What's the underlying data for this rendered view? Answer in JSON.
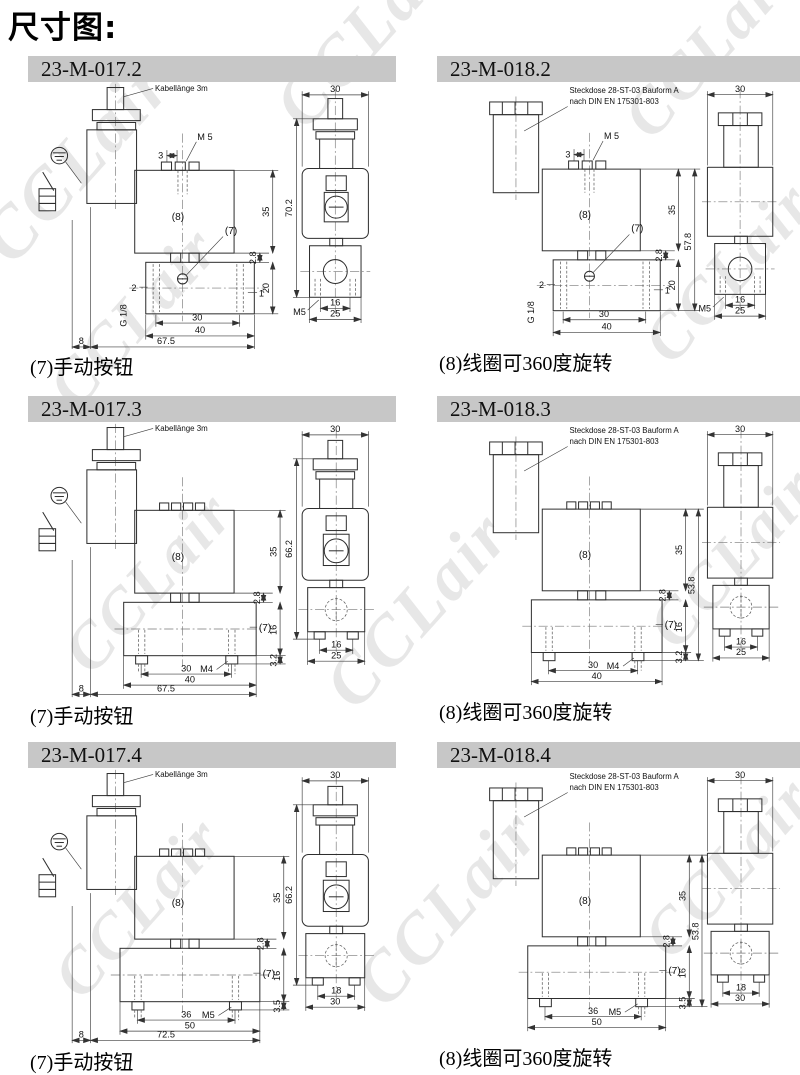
{
  "page": {
    "title": "尺寸图:",
    "watermark": "CCLair"
  },
  "sections": [
    {
      "model": "23-M-017.2",
      "caption": "(7)手动按钮",
      "connector_label": "Kabellänge 3m",
      "side": {
        "pitch": "3",
        "top_thread": "M 5",
        "coil_ref": "(8)",
        "button_ref": "(7)",
        "coil_height": "35",
        "neck_height": "2.8",
        "body_height": "20",
        "port_left": "2",
        "port_right": "1",
        "port_thread": "G 1/8",
        "port_span": "30",
        "body_width": "40",
        "edge_offset": "8",
        "overall_width": "67.5"
      },
      "front": {
        "width": "30",
        "overall_height": "70.2",
        "bottom_thread": "M5",
        "port_span": "16",
        "body_width": "25"
      }
    },
    {
      "model": "23-M-018.2",
      "caption": "(8)线圈可360度旋转",
      "connector_label": "Steckdose 28-ST-03 Bauform A",
      "connector_label2": "nach DIN EN 175301-803",
      "side": {
        "pitch": "3",
        "top_thread": "M 5",
        "coil_ref": "(8)",
        "button_ref": "(7)",
        "coil_height": "35",
        "neck_height": "2.8",
        "body_height": "20",
        "overall_height": "57.8",
        "port_left": "2",
        "port_right": "1",
        "port_thread": "G 1/8",
        "port_span": "30",
        "body_width": "40"
      },
      "front": {
        "width": "30",
        "bottom_thread": "M5",
        "port_span": "16",
        "body_width": "25"
      }
    },
    {
      "model": "23-M-017.3",
      "caption": "(7)手动按钮",
      "connector_label": "Kabellänge 3m",
      "side": {
        "coil_ref": "(8)",
        "button_ref": "(7)",
        "coil_height": "35",
        "neck_height": "2.8",
        "body_height": "16",
        "foot_height": "3.2",
        "foot_thread": "M4",
        "port_span": "30",
        "body_width": "40",
        "edge_offset": "8",
        "overall_width": "67.5"
      },
      "front": {
        "width": "30",
        "overall_height": "66.2",
        "port_span": "16",
        "body_width": "25"
      }
    },
    {
      "model": "23-M-018.3",
      "caption": "(8)线圈可360度旋转",
      "connector_label": "Steckdose 28-ST-03 Bauform A",
      "connector_label2": "nach DIN EN 175301-803",
      "side": {
        "coil_ref": "(8)",
        "button_ref": "(7)",
        "coil_height": "35",
        "neck_height": "2.8",
        "body_height": "16",
        "overall_height": "53.8",
        "foot_height": "3.2",
        "foot_thread": "M4",
        "port_span": "30",
        "body_width": "40"
      },
      "front": {
        "width": "30",
        "port_span": "16",
        "body_width": "25"
      }
    },
    {
      "model": "23-M-017.4",
      "caption": "(7)手动按钮",
      "connector_label": "Kabellänge 3m",
      "side": {
        "coil_ref": "(8)",
        "button_ref": "(7)",
        "coil_height": "35",
        "neck_height": "2.8",
        "body_height": "16",
        "foot_height": "3.5",
        "foot_thread": "M5",
        "port_span": "36",
        "body_width": "50",
        "edge_offset": "8",
        "overall_width": "72.5"
      },
      "front": {
        "width": "30",
        "overall_height": "66.2",
        "port_span": "18",
        "body_width": "30"
      }
    },
    {
      "model": "23-M-018.4",
      "caption": "(8)线圈可360度旋转",
      "connector_label": "Steckdose 28-ST-03 Bauform A",
      "connector_label2": "nach DIN EN 175301-803",
      "side": {
        "coil_ref": "(8)",
        "button_ref": "(7)",
        "coil_height": "35",
        "neck_height": "2.8",
        "body_height": "16",
        "overall_height": "53.8",
        "foot_height": "3.5",
        "foot_thread": "M5",
        "port_span": "36",
        "body_width": "50"
      },
      "front": {
        "width": "30",
        "port_span": "18",
        "body_width": "30"
      }
    }
  ]
}
